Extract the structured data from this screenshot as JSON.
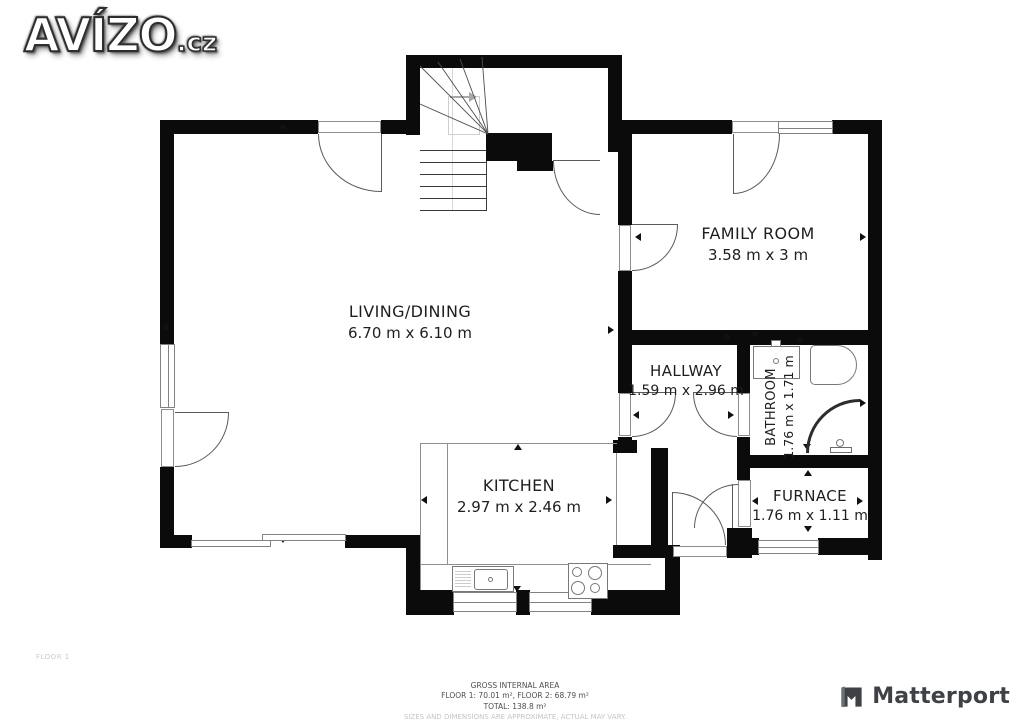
{
  "branding": {
    "logo_text": "AVÍZO",
    "logo_suffix": ".cz",
    "matterport": "Matterport"
  },
  "plan": {
    "floor_label": "FLOOR 1",
    "rooms": {
      "living": {
        "name": "LIVING/DINING",
        "dims": "6.70 m x 6.10 m"
      },
      "family": {
        "name": "FAMILY ROOM",
        "dims": "3.58 m x 3 m"
      },
      "hallway": {
        "name": "HALLWAY",
        "dims": "1.59 m x 2.96 m"
      },
      "bathroom": {
        "name": "BATHROOM",
        "dims": "1.76 m x 1.71 m"
      },
      "kitchen": {
        "name": "KITCHEN",
        "dims": "2.97 m x 2.46 m"
      },
      "furnace": {
        "name": "FURNACE",
        "dims": "1.76 m x 1.11 m"
      }
    }
  },
  "footer": {
    "area_title": "GROSS INTERNAL AREA",
    "area_line1": "FLOOR 1: 70.01 m², FLOOR 2: 68.79 m²",
    "area_line2": "TOTAL: 138.8 m²",
    "disclaimer": "SIZES AND DIMENSIONS ARE APPROXIMATE, ACTUAL MAY VARY."
  },
  "colors": {
    "wall": "#0b0b0b",
    "line": "#8f8f8f",
    "label": "#1e1e1e",
    "muted": "#c4c4c4"
  }
}
